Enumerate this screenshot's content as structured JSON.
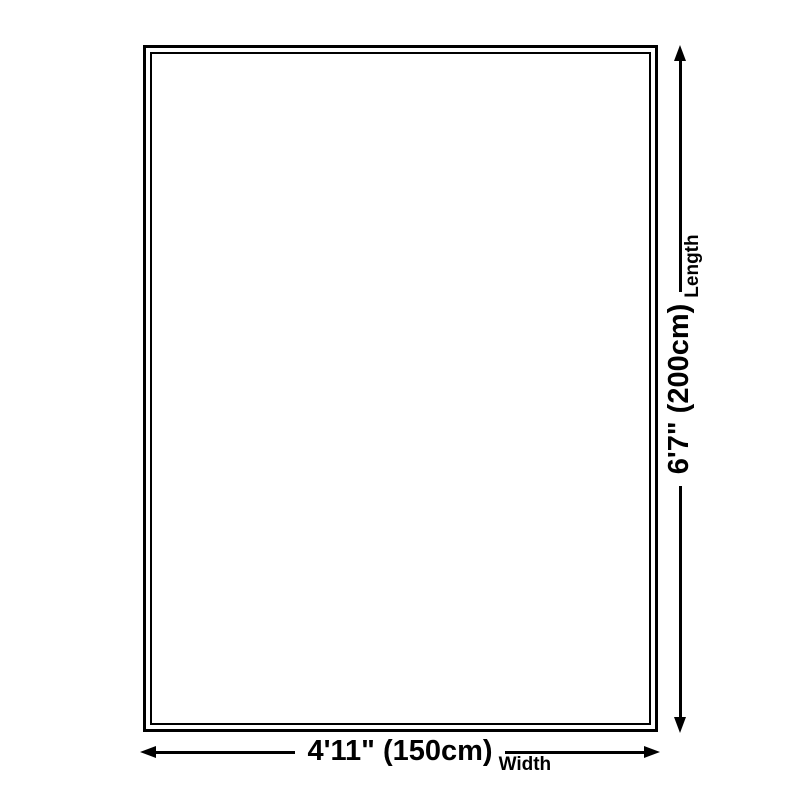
{
  "diagram": {
    "title": "rug-size-diagram",
    "length": {
      "value": "6'7\" (200cm)",
      "label": "Length"
    },
    "width": {
      "value": "4'11\" (150cm)",
      "label": "Width"
    },
    "colors": {
      "line": "#000000",
      "background": "#ffffff"
    }
  }
}
